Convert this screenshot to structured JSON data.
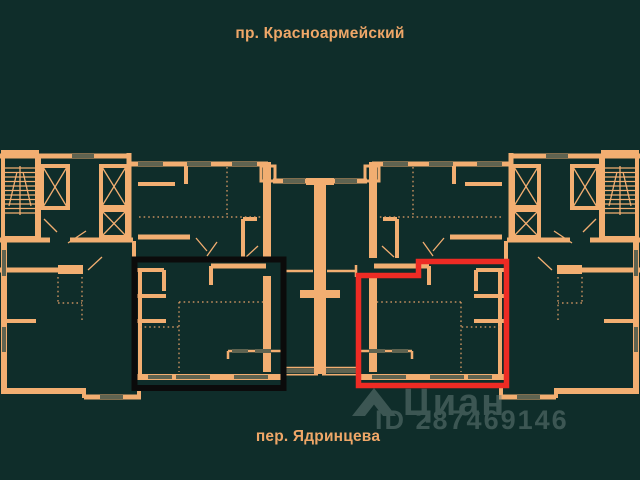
{
  "labels": {
    "street_top": "пр. Красноармейский",
    "street_bottom": "пер. Ядринцева"
  },
  "watermark": {
    "brand": "Циан",
    "listing_id": "ID 287469146",
    "logo_icon": "cian-house-logo-icon"
  },
  "highlights": {
    "black_apartment_outline": {
      "color": "#0b0b0b"
    },
    "red_apartment_outline": {
      "color": "#ee2b24"
    }
  },
  "colors": {
    "background": "#0f2d2a",
    "wall": "#f2ae71",
    "window": "#5f6350",
    "dotted": "#e7a269",
    "highlight_black": "#0b0b0b",
    "highlight_red": "#ee2b24",
    "watermark": "#6a807c",
    "label": "#efa768"
  }
}
